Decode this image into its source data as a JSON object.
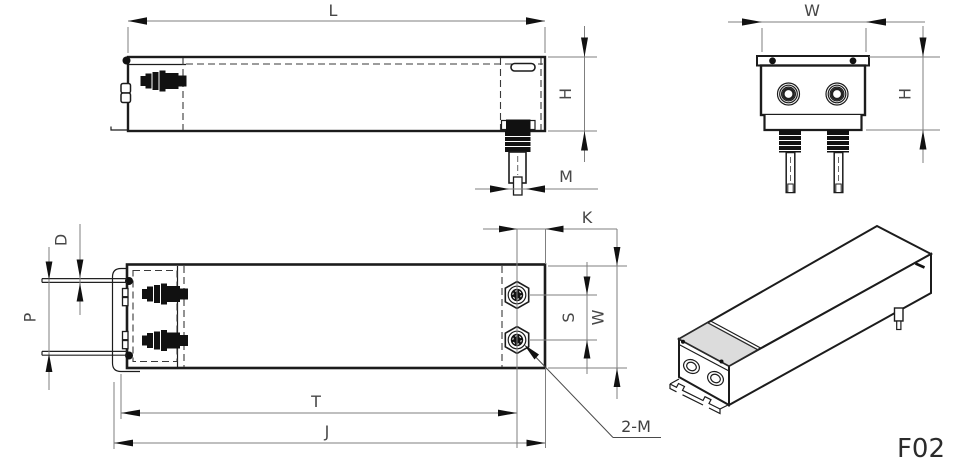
{
  "labels": {
    "length": "L",
    "width_end": "W",
    "height_side": "H",
    "height_end": "H",
    "stud_thread": "M",
    "stud_to_edge": "K",
    "stud_spacing": "S",
    "width_plan": "W",
    "wire_diameter": "D",
    "wire_spacing": "P",
    "stud_span": "T",
    "overall_length": "J",
    "stud_callout": "2-M",
    "model_code": "F02"
  },
  "colors": {
    "outline": "#1c1c1c",
    "dimension_line": "#7f7f7f",
    "label_text": "#474747",
    "lid_fill": "#dcdcdc",
    "background": "#ffffff"
  }
}
